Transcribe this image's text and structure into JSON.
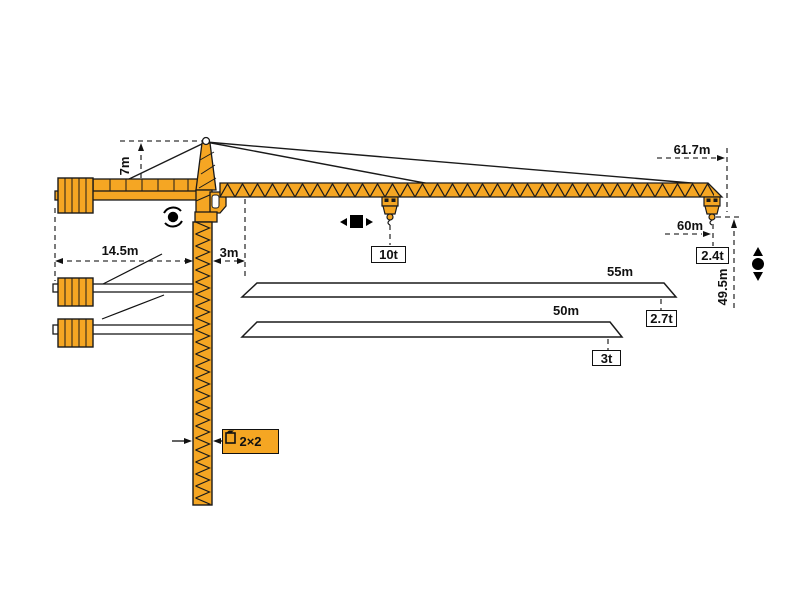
{
  "diagram_title": "tower-crane-working-range-diagram",
  "colors": {
    "crane_orange": "#F5A623",
    "outline": "#1a1a1a",
    "dimension_line": "#333333",
    "label_text": "#111111"
  },
  "dimensions": {
    "head_height": "7m",
    "counterjib_length": "14.5m",
    "slew_offset": "3m",
    "jib_length_full": "61.7m",
    "radius_60": "60m",
    "hook_height": "49.5m",
    "jib_length_55": "55m",
    "jib_length_50": "50m"
  },
  "capacities": {
    "max_load": "10t",
    "tip_load_full": "2.4t",
    "tip_load_55": "2.7t",
    "tip_load_50": "3t"
  },
  "mast": {
    "section_label": "2×2"
  },
  "icons": {
    "slewing": "slewing-rotation-icon",
    "trolley_travel": "trolley-travel-icon (◀■▶)",
    "hoist": "hoist-up-down-icon (▲●▼)",
    "mast_section": "mast-section-icon"
  }
}
